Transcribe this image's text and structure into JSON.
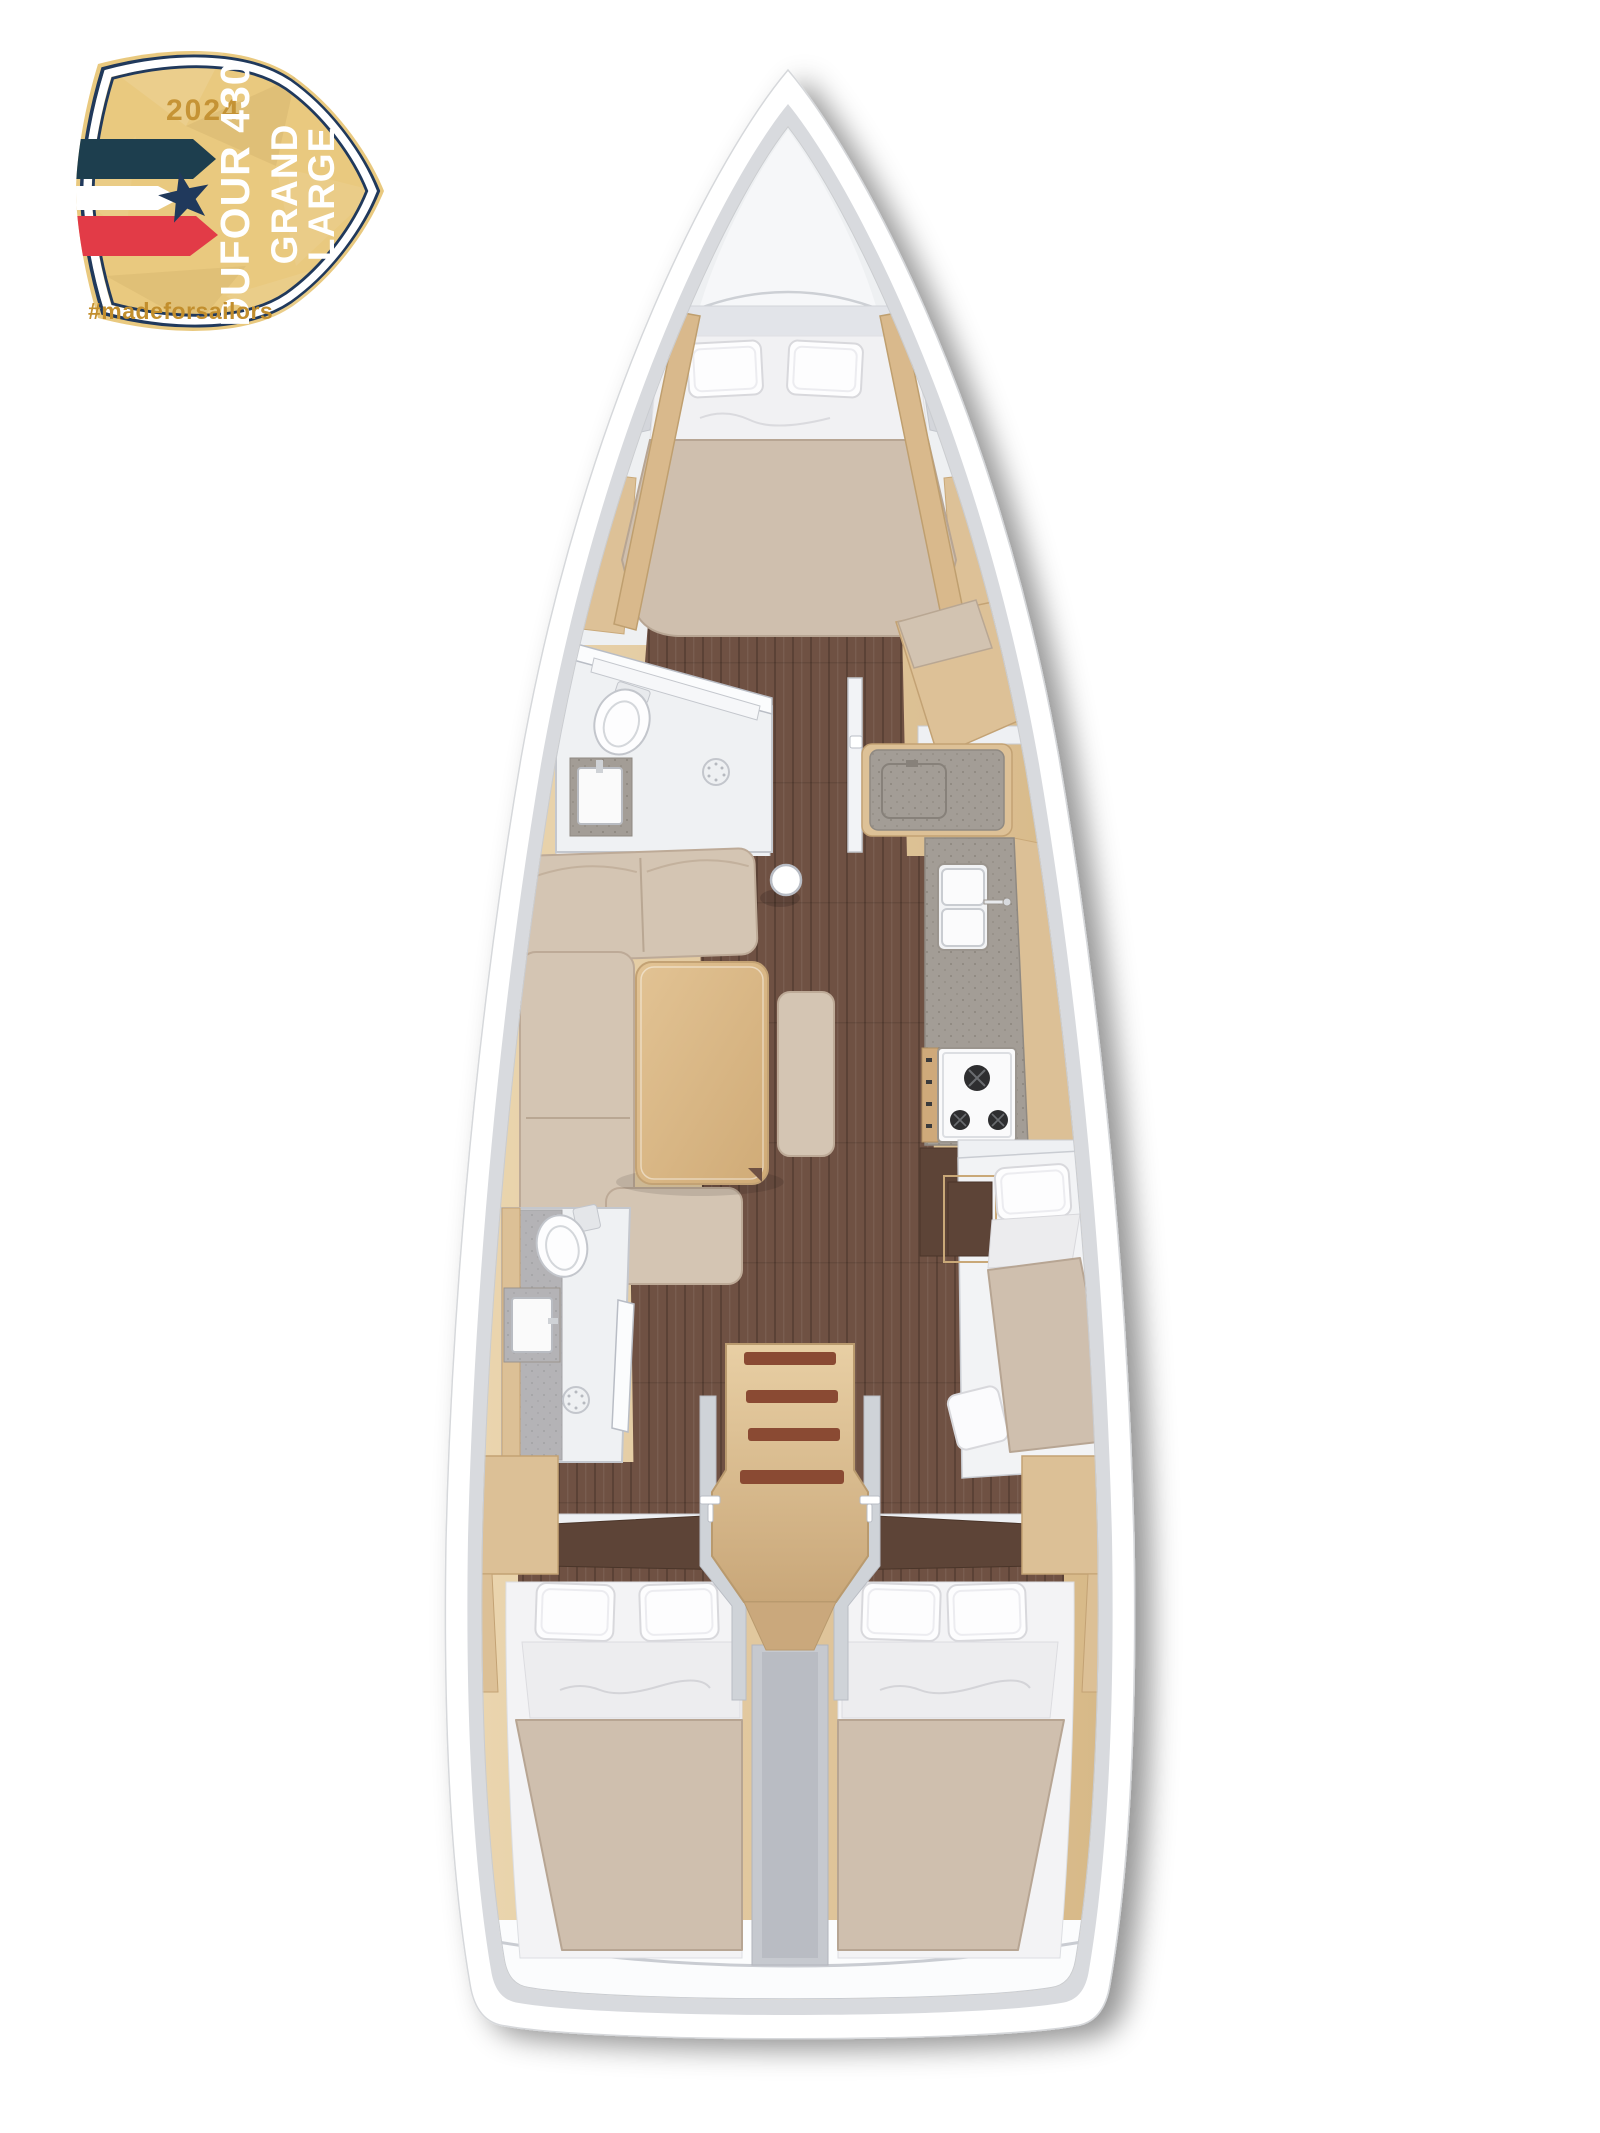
{
  "badge": {
    "year": "2024",
    "title_line1": "DUFOUR 430",
    "title_line2": "GRAND",
    "title_line3": "LARGE",
    "hashtag": "#madeforsailors",
    "colors": {
      "gold": "#e9c97f",
      "navy": "#20395c",
      "teal": "#1d3e4e",
      "red": "#e23b47",
      "text_gold": "#c28e2d",
      "white": "#ffffff"
    }
  },
  "floorplan": {
    "colors": {
      "hull": "#ffffff",
      "lining": "#d8dade",
      "oak": "#dcc096",
      "walnut": "#5d4437",
      "floor": "#6f5143",
      "fabric": "#d4c5b3",
      "bedding_tan": "#cfbfae",
      "bedding_white": "#f3f3f5",
      "counter": "#a29c95",
      "wall": "#cfd3d8",
      "stair_tread": "#8a4a33"
    }
  }
}
